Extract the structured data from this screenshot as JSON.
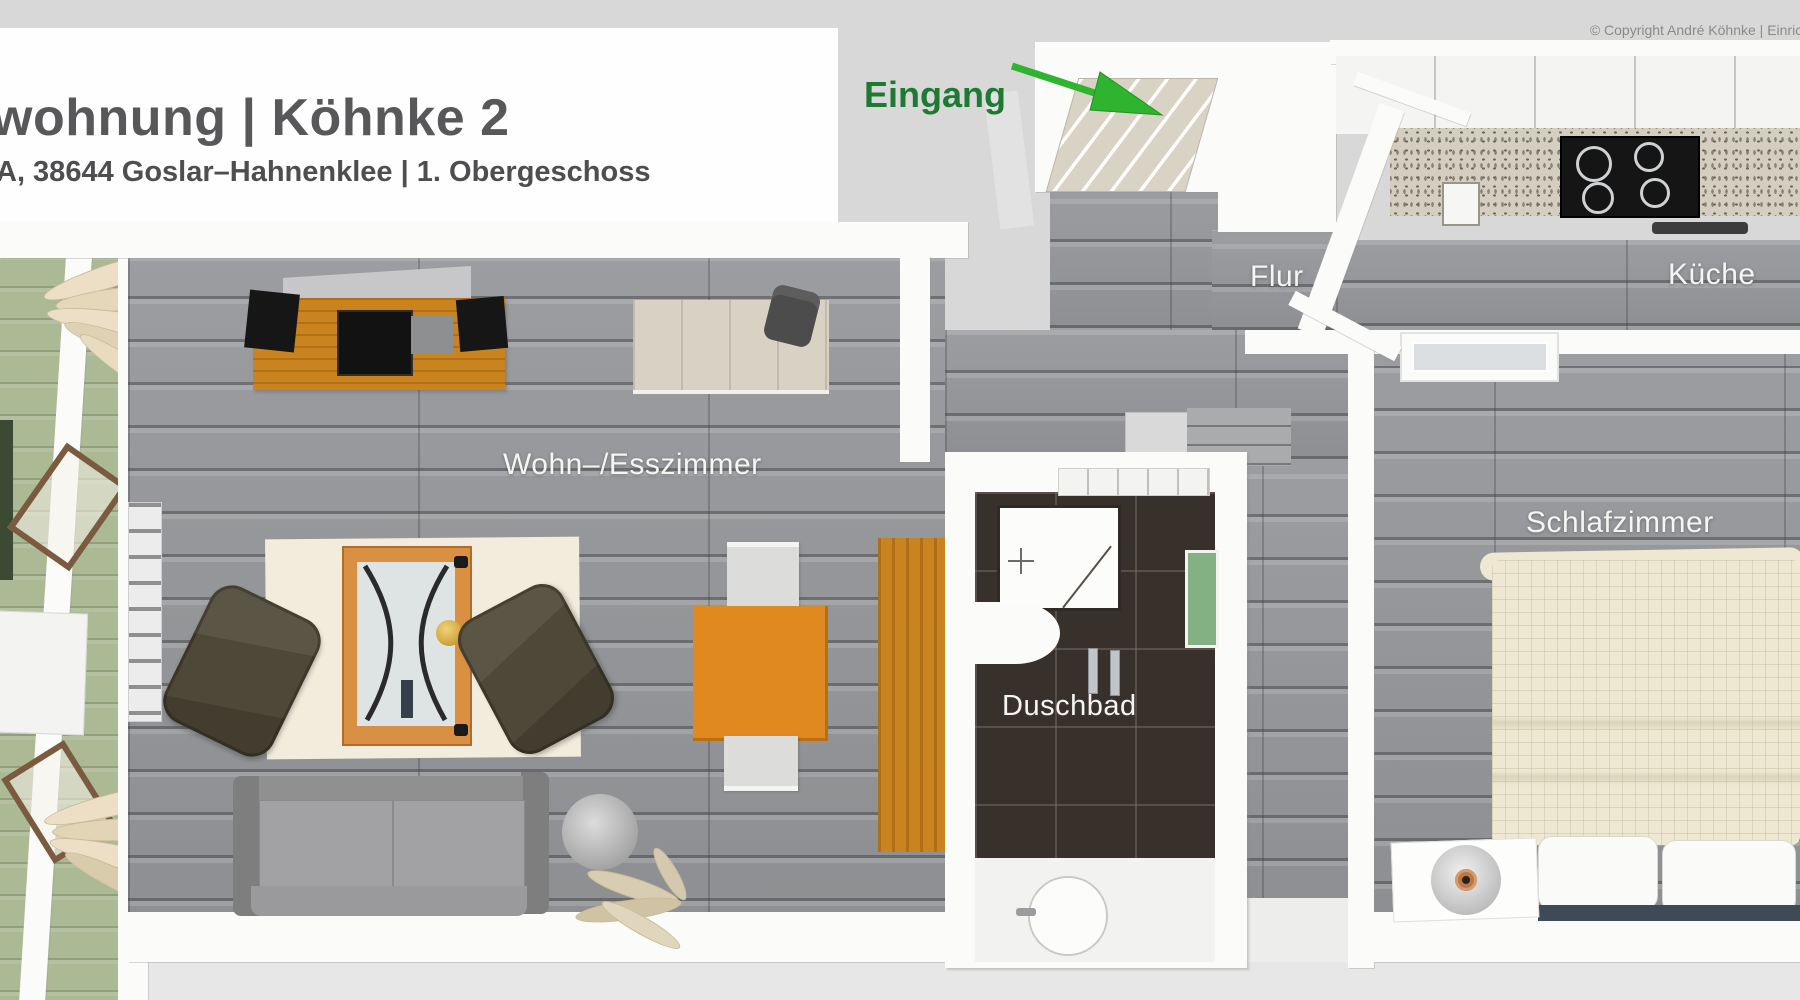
{
  "header": {
    "title": "wohnung | Köhnke 2",
    "subtitle": "A, 38644 Goslar–Hahnenklee | 1. Obergeschoss"
  },
  "copyright": "© Copyright André Köhnke | Einrich",
  "entrance": {
    "label": "Eingang"
  },
  "rooms": {
    "flur": {
      "label": "Flur"
    },
    "kueche": {
      "label": "Küche"
    },
    "wohn_esszimmer": {
      "label": "Wohn–/Esszimmer"
    },
    "duschbad": {
      "label": "Duschbad"
    },
    "schlafzimmer": {
      "label": "Schlafzimmer"
    }
  },
  "colors": {
    "entrance-text": "#1d7a33",
    "arrow-green": "#2eb42e",
    "title-text": "#58585a",
    "copyright-text": "#8a8a8a",
    "label-text": "#f5f5f3",
    "floor-wood": "#95979a",
    "wall-white": "#fbfbfa",
    "outside-gray": "#d8d8d8",
    "balcony-green": "#abb994",
    "tile-dark": "#38302a",
    "furniture-orange": "#e0891f",
    "wood-orange": "#c9841f",
    "sofa-gray": "#9c9c9c",
    "chair-olive": "#4e4939",
    "rug-cream": "#f1ecdc",
    "bed-cream": "#eee8d2",
    "bedframe-navy": "#3e4a57",
    "towel-green": "#83b183"
  }
}
